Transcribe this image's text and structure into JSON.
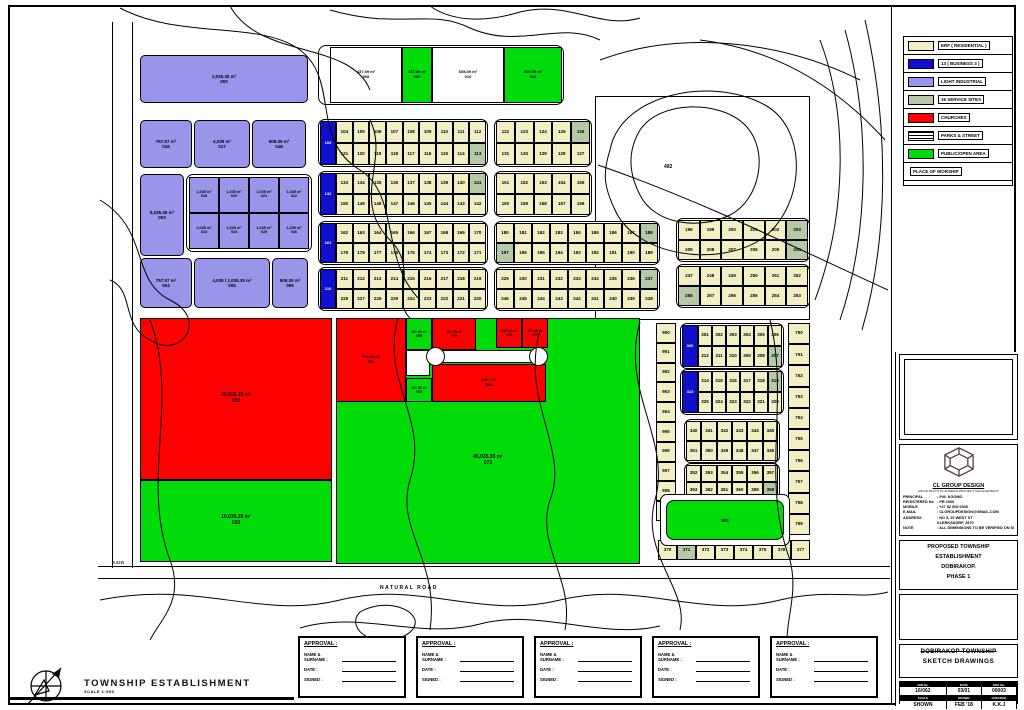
{
  "legend": {
    "items": [
      {
        "label": "ERF ( RESIDENTIAL )",
        "color": "#F2EFC4",
        "swatch": "solid"
      },
      {
        "label": "13 ( BUSINESS 3 )",
        "color": "#1010CC",
        "swatch": "solid"
      },
      {
        "label": "LIGHT INDUSTRIAL",
        "color": "#9895EB",
        "swatch": "solid"
      },
      {
        "label": "16 SERVICE SITES",
        "color": "#B5C9A8",
        "swatch": "solid"
      },
      {
        "label": "CHURCHES",
        "color": "#FF0000",
        "swatch": "solid"
      },
      {
        "label": "PARKS & STREET",
        "color": "stripes",
        "swatch": "stripes"
      },
      {
        "label": "PUBLIC/OPEN AREA",
        "color": "#00DC0A",
        "swatch": "solid"
      },
      {
        "label": "PLACE OF WORSHIP",
        "color": "",
        "swatch": "none"
      }
    ]
  },
  "title_block": {
    "company": {
      "name": "CL GROUP DESIGN",
      "tagline": "ARCHITECTS  PLANNERS  PROJECT MANAGEMENT",
      "rows": [
        [
          "PRINCIPAL",
          ": P.M. KGOMO"
        ],
        [
          "REGISTERED No",
          ": PR 2000"
        ],
        [
          "MOBILE",
          ": +27 82 000 0000"
        ],
        [
          "E-MAIL",
          ": CLGROUPDESIGN@GMAIL.COM"
        ],
        [
          "ADDRESS",
          ": NO 5, 20 WEST ST"
        ],
        [
          "",
          "  KLERKSDORP, 2570"
        ],
        [
          "NOTE",
          ": ALL DIMENSIONS TO BE VERIFIED ON SITE"
        ]
      ]
    },
    "project_lines": [
      "PROPOSED TOWNSHIP",
      "ESTABLISHMENT",
      "DOBIRAKOP.",
      "PHASE 1"
    ],
    "drawing_title": [
      "DOBIRAKOP TOWNSHIP",
      "SKETCH DRAWINGS"
    ],
    "table": {
      "headers1": [
        "JOB No.",
        "DATE",
        "DRG No."
      ],
      "values1": [
        "16/062",
        "03/01",
        "00003"
      ],
      "headers2": [
        "SCALE",
        "DRAWN",
        "CHECKED"
      ],
      "values2": [
        "SHOWN",
        "FEB '18",
        "K.K.J"
      ]
    }
  },
  "approvals": {
    "count": 5,
    "title": "APPROVAL :",
    "fields": [
      "NAME & SURNAME :",
      "DATE :",
      "SIGNED :"
    ]
  },
  "footer": {
    "title": "TOWNSHIP ESTABLISHMENT",
    "scale": "SCALE 1:500"
  },
  "map": {
    "colors": {
      "cream": "#F2EFC4",
      "blue": "#1010CC",
      "purple": "#9895EB",
      "service": "#B5C9A8",
      "red": "#FF0000",
      "green": "#00DC0A",
      "white": "#FFFFFF"
    },
    "labels": [
      {
        "x": 380,
        "y": 585,
        "text": "NATURAL ROAD",
        "size": 5,
        "spacing": 1.5
      },
      {
        "x": 664,
        "y": 164,
        "text": "492",
        "size": 5,
        "spacing": 0
      },
      {
        "x": 112,
        "y": 560,
        "text": "R STR",
        "size": 4,
        "spacing": 0
      }
    ],
    "zones": [
      {
        "x": 595,
        "y": 96,
        "w": 215,
        "h": 224,
        "color": "white",
        "area": "",
        "num": "",
        "name": "dam-contour-area",
        "fs": 5
      },
      {
        "x": 140,
        "y": 318,
        "w": 192,
        "h": 162,
        "color": "red",
        "area": "30,035.35 m²",
        "num": "032",
        "fs": 5
      },
      {
        "x": 140,
        "y": 480,
        "w": 192,
        "h": 82,
        "color": "green",
        "area": "10,035.35 m²",
        "num": "033",
        "fs": 5
      },
      {
        "x": 336,
        "y": 318,
        "w": 304,
        "h": 246,
        "color": "green",
        "area": "45,035.35 m²",
        "num": "073",
        "fs": 5,
        "labelShift": 40
      },
      {
        "x": 336,
        "y": 318,
        "w": 70,
        "h": 84,
        "color": "red",
        "area": "500.50 m²",
        "num": "064",
        "fs": 4
      },
      {
        "x": 406,
        "y": 318,
        "w": 26,
        "h": 32,
        "color": "green",
        "area": "437.09 m²",
        "num": "059",
        "fs": 3.5
      },
      {
        "x": 432,
        "y": 318,
        "w": 44,
        "h": 32,
        "color": "red",
        "area": "437.09 m²",
        "num": "065",
        "fs": 3.5
      },
      {
        "x": 496,
        "y": 318,
        "w": 26,
        "h": 30,
        "color": "red",
        "area": "437.09 m²",
        "num": "066",
        "fs": 3.5
      },
      {
        "x": 522,
        "y": 318,
        "w": 26,
        "h": 30,
        "color": "red",
        "area": "437.09 m²",
        "num": "067",
        "fs": 3.5
      },
      {
        "x": 432,
        "y": 364,
        "w": 114,
        "h": 38,
        "color": "red",
        "area": "940.7 m²",
        "num": "068",
        "fs": 4
      },
      {
        "x": 406,
        "y": 350,
        "w": 24,
        "h": 26,
        "color": "white",
        "area": "",
        "num": "",
        "fs": 4
      },
      {
        "x": 406,
        "y": 378,
        "w": 26,
        "h": 24,
        "color": "green",
        "area": "437.09 m²",
        "num": "063",
        "fs": 3.5
      }
    ],
    "row_a": {
      "outline": {
        "x": 318,
        "y": 45,
        "w": 246,
        "h": 60
      },
      "plots": [
        {
          "x": 330,
          "y": 47,
          "w": 72,
          "h": 56,
          "color": "white",
          "area": "437.09 m²",
          "num": "008"
        },
        {
          "x": 402,
          "y": 47,
          "w": 30,
          "h": 56,
          "color": "green",
          "area": "437.09 m²",
          "num": "009"
        },
        {
          "x": 432,
          "y": 47,
          "w": 72,
          "h": 56,
          "color": "white",
          "area": "655.09 m²",
          "num": "010"
        },
        {
          "x": 504,
          "y": 47,
          "w": 58,
          "h": 56,
          "color": "green",
          "area": "509.35 m²",
          "num": "034"
        }
      ]
    },
    "industrial": [
      {
        "x": 140,
        "y": 55,
        "w": 168,
        "h": 48,
        "area": "1,035.35 m²",
        "num": "002"
      },
      {
        "x": 140,
        "y": 120,
        "w": 52,
        "h": 48,
        "area": "757.57 m²",
        "num": "016"
      },
      {
        "x": 194,
        "y": 120,
        "w": 56,
        "h": 48,
        "area": "4,035 m²",
        "num": "017"
      },
      {
        "x": 252,
        "y": 120,
        "w": 54,
        "h": 48,
        "area": "509.35 m²",
        "num": "018"
      },
      {
        "x": 140,
        "y": 174,
        "w": 44,
        "h": 82,
        "area": "6,035.35 m²",
        "num": "003"
      },
      {
        "x": 140,
        "y": 258,
        "w": 52,
        "h": 50,
        "area": "757.57 m²",
        "num": "004"
      },
      {
        "x": 194,
        "y": 258,
        "w": 76,
        "h": 50,
        "area": "4,035 / 1,035.35 m²",
        "num": "005"
      },
      {
        "x": 272,
        "y": 258,
        "w": 36,
        "h": 50,
        "area": "509.35 m²",
        "num": "006"
      }
    ],
    "icell_block": {
      "x": 186,
      "y": 174,
      "w": 126,
      "h": 78,
      "rows": [
        [
          "019",
          "020",
          "021",
          "022"
        ],
        [
          "023",
          "024",
          "025",
          "026"
        ]
      ],
      "area": "1,035 m²"
    },
    "grids": [
      {
        "x": 318,
        "y": 119,
        "w": 170,
        "h": 48,
        "blue": "103",
        "rows": [
          [
            "104",
            "105",
            "106",
            "107",
            "108",
            "109",
            "110",
            "111",
            "112"
          ],
          [
            "121",
            "120",
            "119",
            "118",
            "117",
            "116",
            "115",
            "114",
            "113"
          ]
        ],
        "svc": [
          [
            1,
            8
          ]
        ]
      },
      {
        "x": 494,
        "y": 119,
        "w": 98,
        "h": 48,
        "rows": [
          [
            "122",
            "123",
            "124",
            "125",
            "126"
          ],
          [
            "131",
            "130",
            "129",
            "128",
            "127"
          ]
        ],
        "svc": [
          [
            0,
            4
          ]
        ]
      },
      {
        "x": 318,
        "y": 171,
        "w": 170,
        "h": 46,
        "blue": "132",
        "rows": [
          [
            "133",
            "134",
            "135",
            "136",
            "137",
            "138",
            "139",
            "140",
            "141"
          ],
          [
            "150",
            "149",
            "148",
            "147",
            "146",
            "145",
            "144",
            "143",
            "142"
          ]
        ],
        "svc": [
          [
            0,
            8
          ]
        ]
      },
      {
        "x": 494,
        "y": 171,
        "w": 98,
        "h": 46,
        "rows": [
          [
            "151",
            "152",
            "153",
            "154",
            "155"
          ],
          [
            "160",
            "159",
            "158",
            "157",
            "156"
          ]
        ],
        "svc": []
      },
      {
        "x": 318,
        "y": 221,
        "w": 170,
        "h": 44,
        "blue": "161",
        "rows": [
          [
            "162",
            "163",
            "164",
            "165",
            "166",
            "167",
            "168",
            "169",
            "170"
          ],
          [
            "179",
            "178",
            "177",
            "176",
            "175",
            "174",
            "173",
            "172",
            "171"
          ]
        ],
        "svc": []
      },
      {
        "x": 494,
        "y": 221,
        "w": 166,
        "h": 44,
        "rows": [
          [
            "180",
            "181",
            "182",
            "183",
            "184",
            "185",
            "186",
            "187",
            "188"
          ],
          [
            "197",
            "196",
            "195",
            "194",
            "193",
            "192",
            "191",
            "190",
            "189"
          ]
        ],
        "svc": [
          [
            0,
            8
          ],
          [
            1,
            0
          ]
        ]
      },
      {
        "x": 676,
        "y": 218,
        "w": 134,
        "h": 44,
        "rows": [
          [
            "198",
            "199",
            "200",
            "201",
            "202",
            "203"
          ],
          [
            "209",
            "208",
            "207",
            "206",
            "205",
            "204"
          ]
        ],
        "svc": [
          [
            0,
            5
          ],
          [
            1,
            5
          ]
        ]
      },
      {
        "x": 318,
        "y": 267,
        "w": 170,
        "h": 44,
        "blue": "210",
        "rows": [
          [
            "211",
            "212",
            "213",
            "214",
            "215",
            "216",
            "217",
            "218",
            "219"
          ],
          [
            "228",
            "227",
            "226",
            "225",
            "224",
            "223",
            "222",
            "221",
            "220"
          ]
        ],
        "svc": []
      },
      {
        "x": 494,
        "y": 267,
        "w": 166,
        "h": 44,
        "rows": [
          [
            "229",
            "230",
            "231",
            "232",
            "233",
            "234",
            "235",
            "236",
            "237"
          ],
          [
            "246",
            "245",
            "244",
            "243",
            "242",
            "241",
            "240",
            "239",
            "238"
          ]
        ],
        "svc": [
          [
            0,
            8
          ]
        ]
      },
      {
        "x": 676,
        "y": 264,
        "w": 134,
        "h": 44,
        "rows": [
          [
            "247",
            "248",
            "249",
            "250",
            "251",
            "252"
          ],
          [
            "258",
            "257",
            "256",
            "255",
            "254",
            "253"
          ]
        ],
        "svc": [
          [
            1,
            0
          ]
        ]
      },
      {
        "x": 680,
        "y": 323,
        "w": 104,
        "h": 46,
        "blue": "300",
        "rows": [
          [
            "301",
            "302",
            "303",
            "304",
            "305",
            "306"
          ],
          [
            "312",
            "311",
            "310",
            "309",
            "308",
            "307"
          ]
        ],
        "svc": [
          [
            1,
            5
          ]
        ]
      },
      {
        "x": 680,
        "y": 369,
        "w": 104,
        "h": 46,
        "blue": "313",
        "rows": [
          [
            "314",
            "315",
            "316",
            "317",
            "318",
            "319"
          ],
          [
            "325",
            "324",
            "323",
            "322",
            "321",
            "320"
          ]
        ],
        "svc": [
          [
            0,
            5
          ]
        ]
      },
      {
        "x": 684,
        "y": 419,
        "w": 96,
        "h": 44,
        "rows": [
          [
            "340",
            "341",
            "342",
            "343",
            "344",
            "345"
          ],
          [
            "351",
            "350",
            "349",
            "348",
            "347",
            "346"
          ]
        ],
        "svc": []
      },
      {
        "x": 684,
        "y": 463,
        "w": 96,
        "h": 38,
        "rows": [
          [
            "352",
            "353",
            "354",
            "355",
            "356",
            "357"
          ],
          [
            "363",
            "362",
            "361",
            "360",
            "359",
            "358"
          ]
        ],
        "svc": [
          [
            1,
            5
          ]
        ]
      }
    ],
    "strips": [
      {
        "x": 656,
        "y": 323,
        "w": 20,
        "h": 198,
        "dir": "v",
        "cells": [
          "900",
          "901",
          "902",
          "903",
          "904",
          "905",
          "906",
          "907",
          "908",
          "909"
        ],
        "svc": []
      },
      {
        "x": 788,
        "y": 323,
        "w": 22,
        "h": 212,
        "dir": "v",
        "cells": [
          "750",
          "751",
          "752",
          "753",
          "754",
          "755",
          "756",
          "757",
          "758",
          "759"
        ],
        "svc": []
      },
      {
        "x": 658,
        "y": 540,
        "w": 152,
        "h": 20,
        "dir": "h",
        "cells": [
          "370",
          "371",
          "372",
          "373",
          "374",
          "375",
          "376",
          "377"
        ],
        "svc": [
          1
        ]
      }
    ],
    "green_bar": {
      "x": 666,
      "y": 500,
      "w": 118,
      "h": 40,
      "num": "962"
    }
  }
}
